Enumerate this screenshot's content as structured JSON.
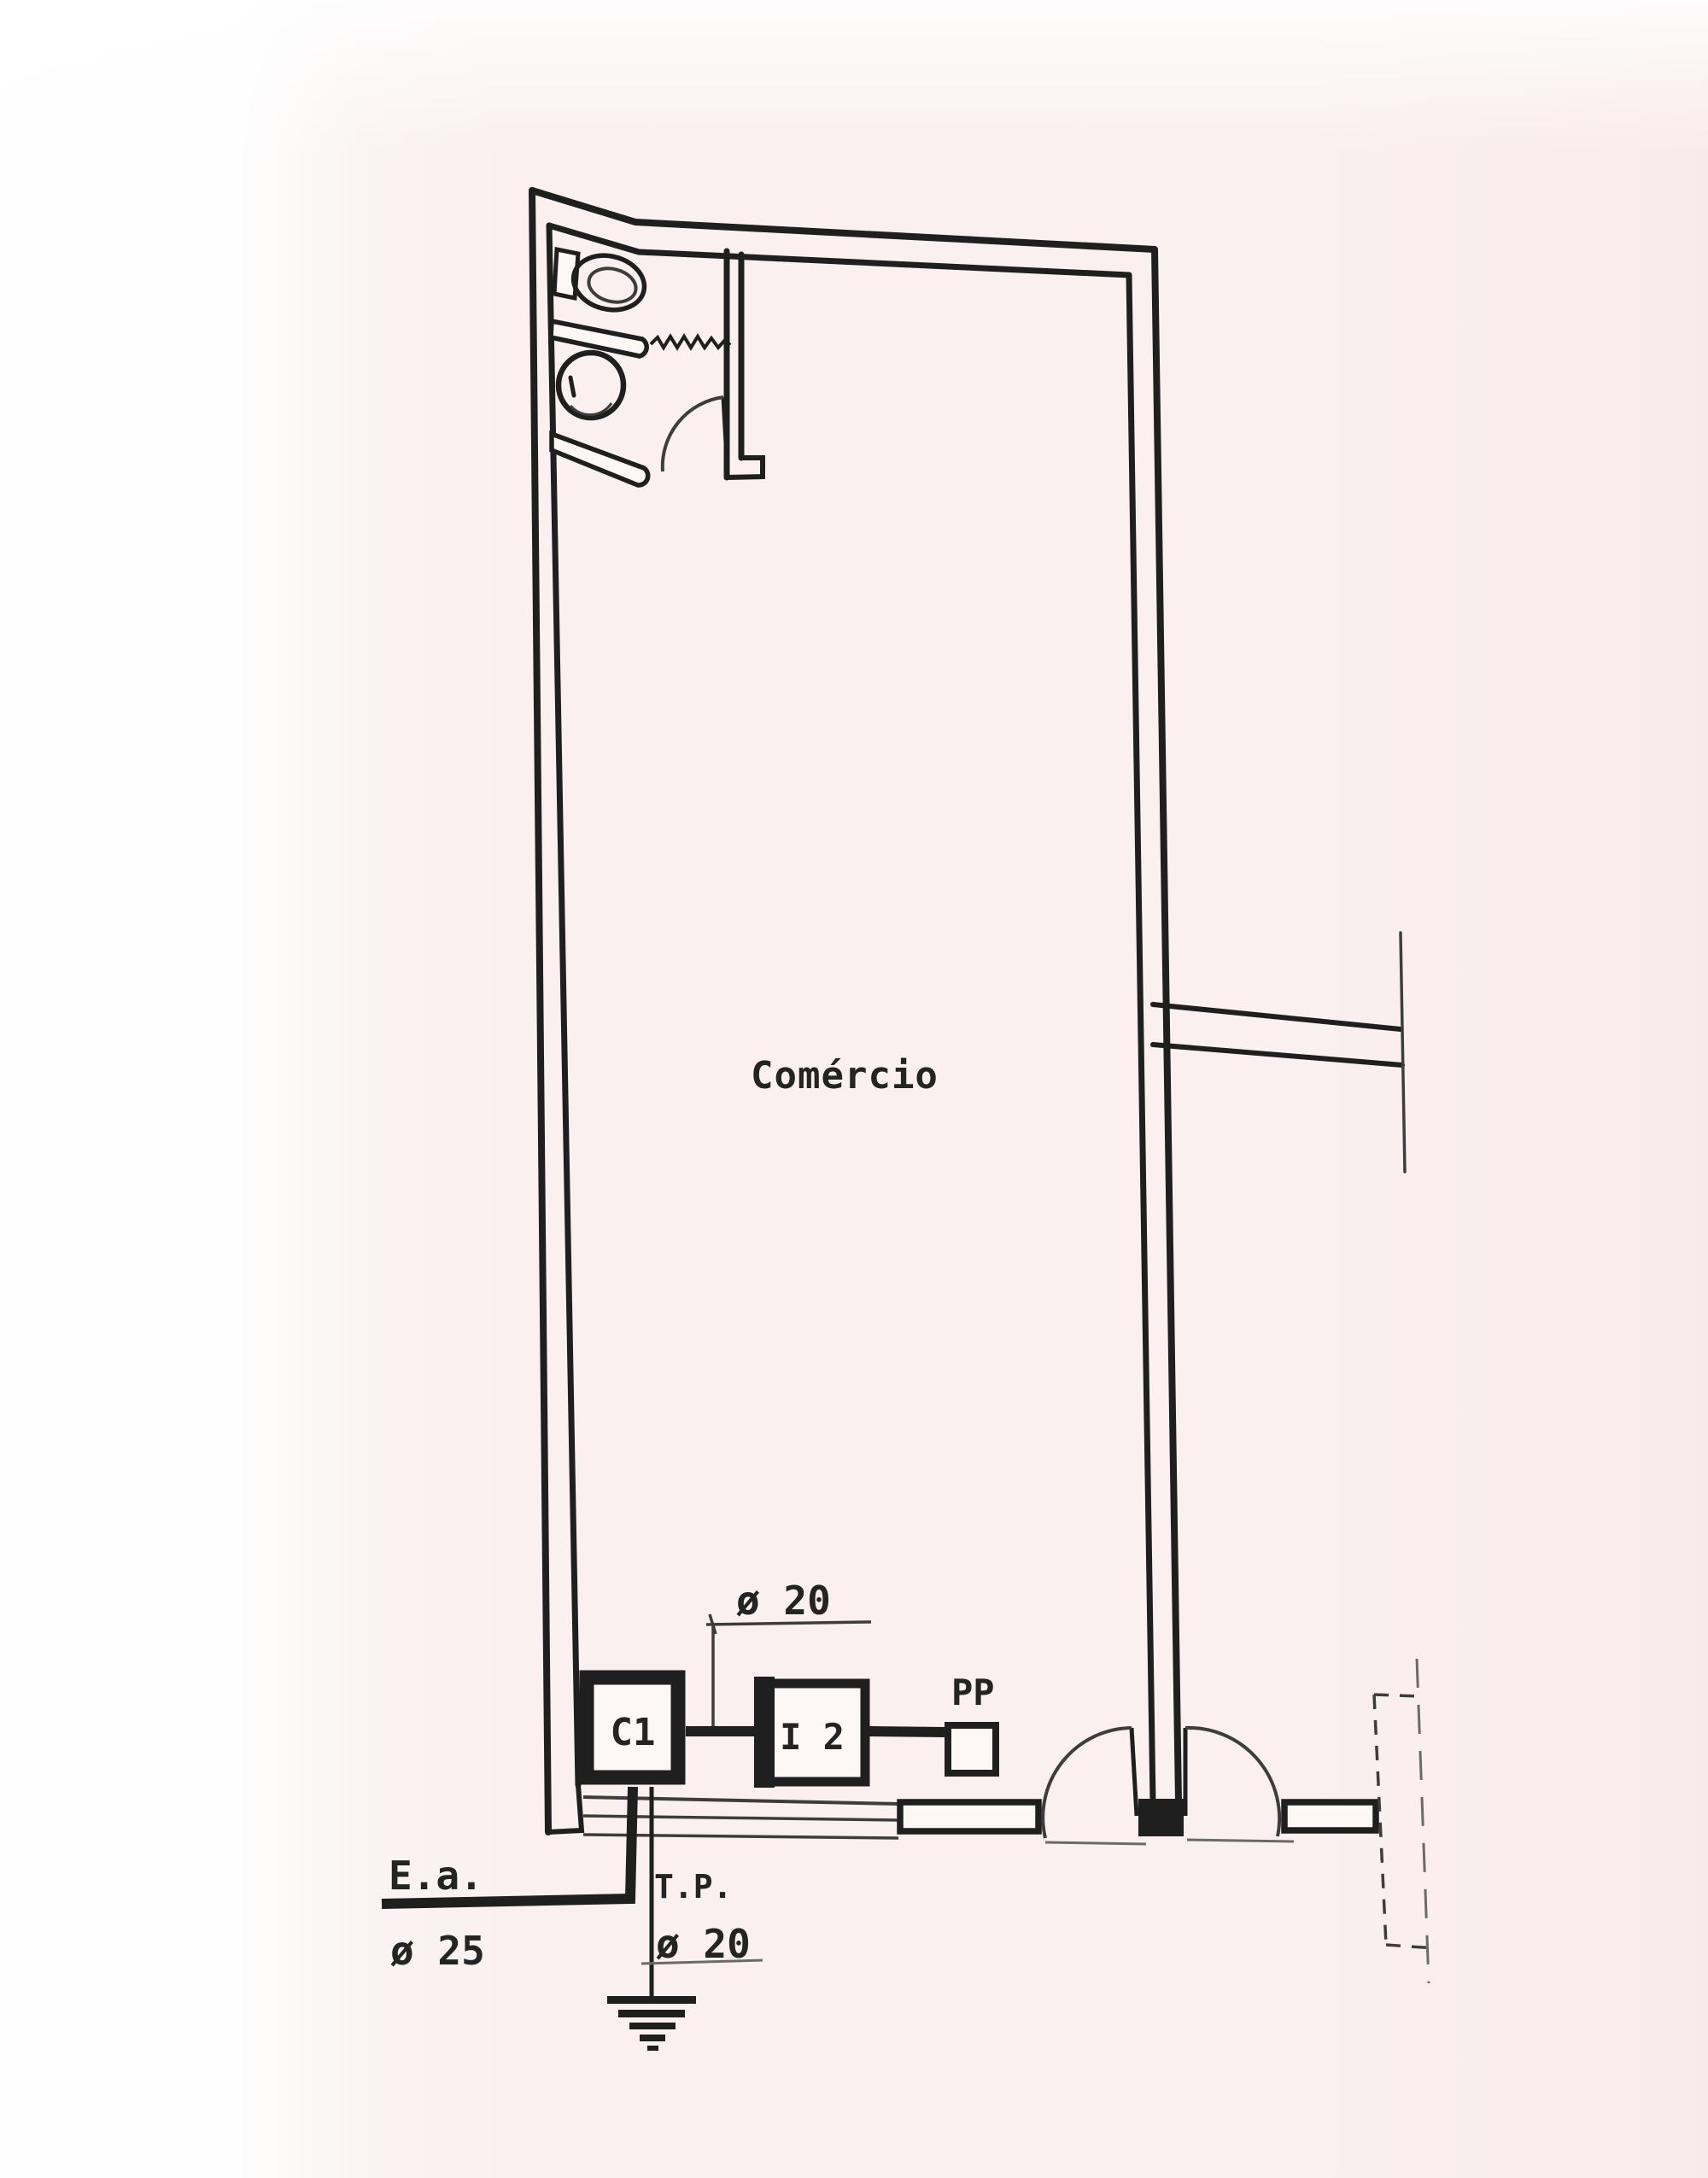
{
  "drawing": {
    "kind": "electrical floor plan sketch",
    "colors": {
      "paper": "#faf0f0",
      "ink": "#1f1f1f"
    }
  },
  "room": {
    "label": "Comércio"
  },
  "equipment": {
    "c1_label": "C1",
    "i2_label": "I 2",
    "pp_label": "PP"
  },
  "annotations": {
    "top_conduit_diameter": "ø 20",
    "ea_label": "E.a.",
    "ea_diameter": "ø 25",
    "tp_label": "T.P.",
    "tp_diameter": "ø 20"
  }
}
